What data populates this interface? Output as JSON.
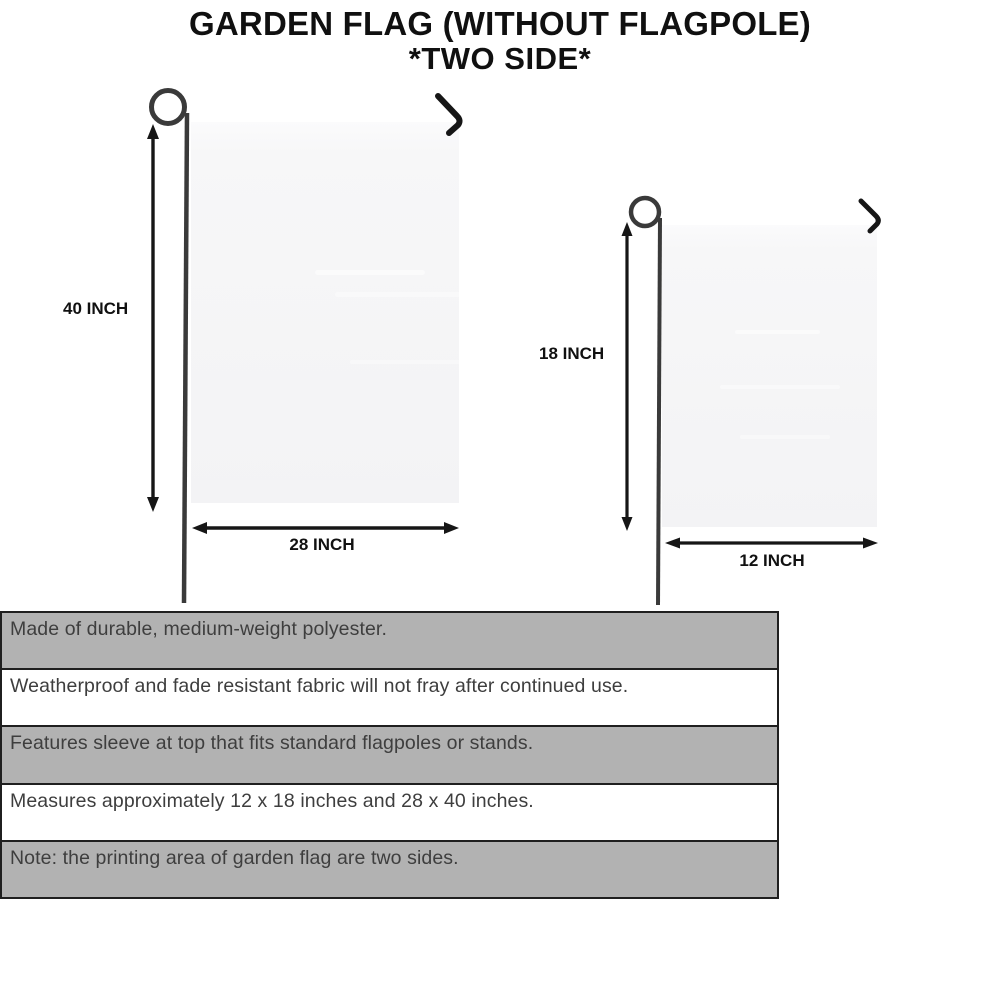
{
  "title": {
    "line1": "GARDEN FLAG (WITHOUT FLAGPOLE)",
    "line2": "*TWO SIDE*"
  },
  "diagram": {
    "large_flag": {
      "name": "large garden flag 28 x 40 inches",
      "height_label": "40 INCH",
      "width_label": "28 INCH"
    },
    "small_flag": {
      "name": "small garden flag 12 x 18 inches",
      "height_label": "18 INCH",
      "width_label": "12 INCH"
    }
  },
  "features": [
    {
      "text": "Made of durable, medium-weight polyester.",
      "highlighted": true
    },
    {
      "text": "Weatherproof and fade resistant fabric will not fray after continued use.",
      "highlighted": false
    },
    {
      "text": "Features sleeve at top that fits standard flagpoles or stands.",
      "highlighted": true
    },
    {
      "text": "Measures approximately 12 x 18 inches and 28 x 40 inches.",
      "highlighted": false
    },
    {
      "text": "Note: the printing area of garden flag are two sides.",
      "highlighted": true
    }
  ],
  "colors": {
    "bar_gray": "#b2b2b2",
    "bar_border": "#1f1f1f",
    "flag_fill": "#f5f5f6",
    "ink": "#161616",
    "pole": "#3a3a3a",
    "feature_text": "#3e3e3e"
  }
}
